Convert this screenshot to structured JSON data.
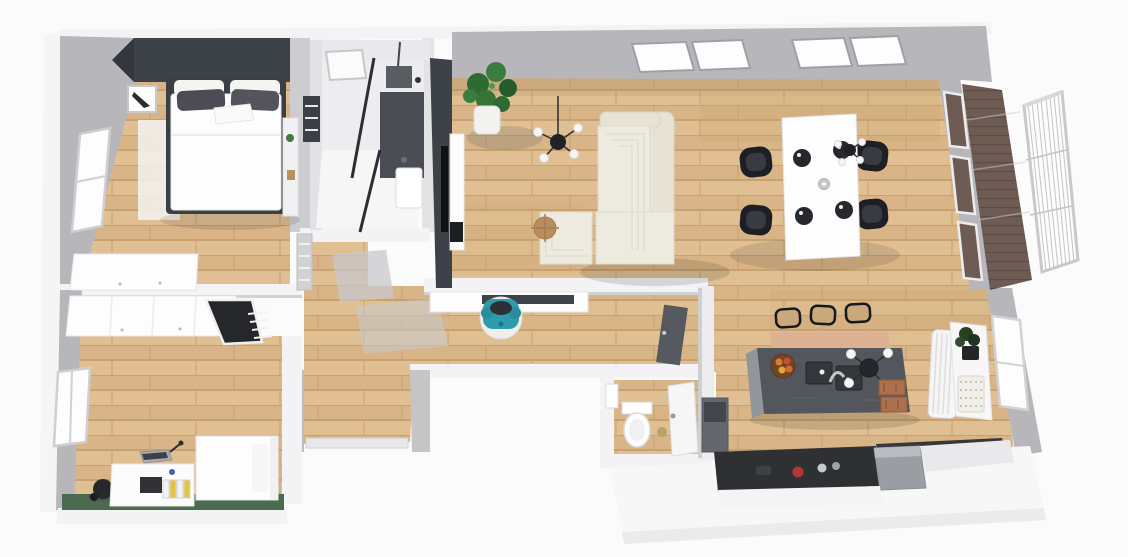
{
  "view": {
    "type": "3d-floor-plan-render",
    "description-semantic": "top-down 3d rendering of an apartment floor plan",
    "background": "#fbfbfc"
  },
  "palette": {
    "wall_face": "#b7b7bb",
    "wall_face_light": "#cdcdd0",
    "wall_top": "#f3f3f5",
    "accent_wall": "#3d4249",
    "floor_plank_a": "#e0c092",
    "floor_plank_b": "#d8b486",
    "plank_line": "#c8a170",
    "deck_wood": "#6e5c54",
    "deck_line": "#5c4c45",
    "green_rug": "#4a6b50",
    "sofa_cream": "#edeadf",
    "sofa_edge": "#e6e2d4",
    "teal_chair": "#2f9cae",
    "black_furniture": "#1d1f24",
    "island_top": "#53565c",
    "island_side": "#92959a",
    "breakfast_bar": "#ddb293",
    "crate_wood": "#ad6f4c",
    "counter_dark": "#2e3033",
    "fridge_gray": "#9a9da2",
    "window_glass": "#fdfdfe",
    "marble_wall": "#e9e9ec",
    "shower_dark": "#4a4e54",
    "rug_gray": "#c8c8cc",
    "door_dark": "#565a60",
    "plant_green": "#2e6b34",
    "pot_white": "#f2f2f0",
    "bed_white": "#fdfdfe",
    "pillow_dark": "#4c4c54",
    "binder_yellow": "#e8c23a",
    "fruit_orange": "#e07b2a",
    "side_table_wood": "#b98e5f"
  },
  "rooms": [
    {
      "id": "bedroom",
      "items": [
        "double-bed",
        "dark-pillows",
        "accent-wall",
        "picture-frame",
        "wardrobe",
        "window",
        "shelf",
        "white-rug"
      ]
    },
    {
      "id": "bathroom",
      "items": [
        "skylight",
        "shower",
        "glass-partition",
        "shower-head",
        "towel-radiator",
        "toilet-vanity",
        "marble-walls"
      ]
    },
    {
      "id": "hallway",
      "items": [
        "console-table",
        "teal-armchair",
        "round-rug",
        "radiator",
        "door-mats",
        "front-door",
        "dark-door-leaf"
      ]
    },
    {
      "id": "living-room",
      "items": [
        "tv-accent-wall",
        "tv",
        "tv-console",
        "potted-plant",
        "pendant-lamp",
        "corner-sofa",
        "ottoman",
        "side-table",
        "wall-windows"
      ]
    },
    {
      "id": "dining-area",
      "items": [
        "dining-table",
        "four-black-chairs",
        "place-settings",
        "candle",
        "pendant-lamp"
      ]
    },
    {
      "id": "balcony",
      "items": [
        "glass-wall",
        "wood-deck",
        "railing"
      ]
    },
    {
      "id": "office",
      "items": [
        "wardrobe",
        "corner-desk-dark",
        "desk",
        "laptop",
        "binders",
        "desk-chair",
        "single-bed",
        "window",
        "green-rug"
      ]
    },
    {
      "id": "wc",
      "items": [
        "toilet",
        "basin",
        "door"
      ]
    },
    {
      "id": "kitchen",
      "items": [
        "island",
        "double-sink",
        "faucet",
        "fruit-bowl",
        "chandelier",
        "bar-stools",
        "breakfast-bar",
        "crates",
        "tall-appliance",
        "counter",
        "kettle",
        "fridge",
        "radiator",
        "plant",
        "basket",
        "window"
      ]
    }
  ]
}
